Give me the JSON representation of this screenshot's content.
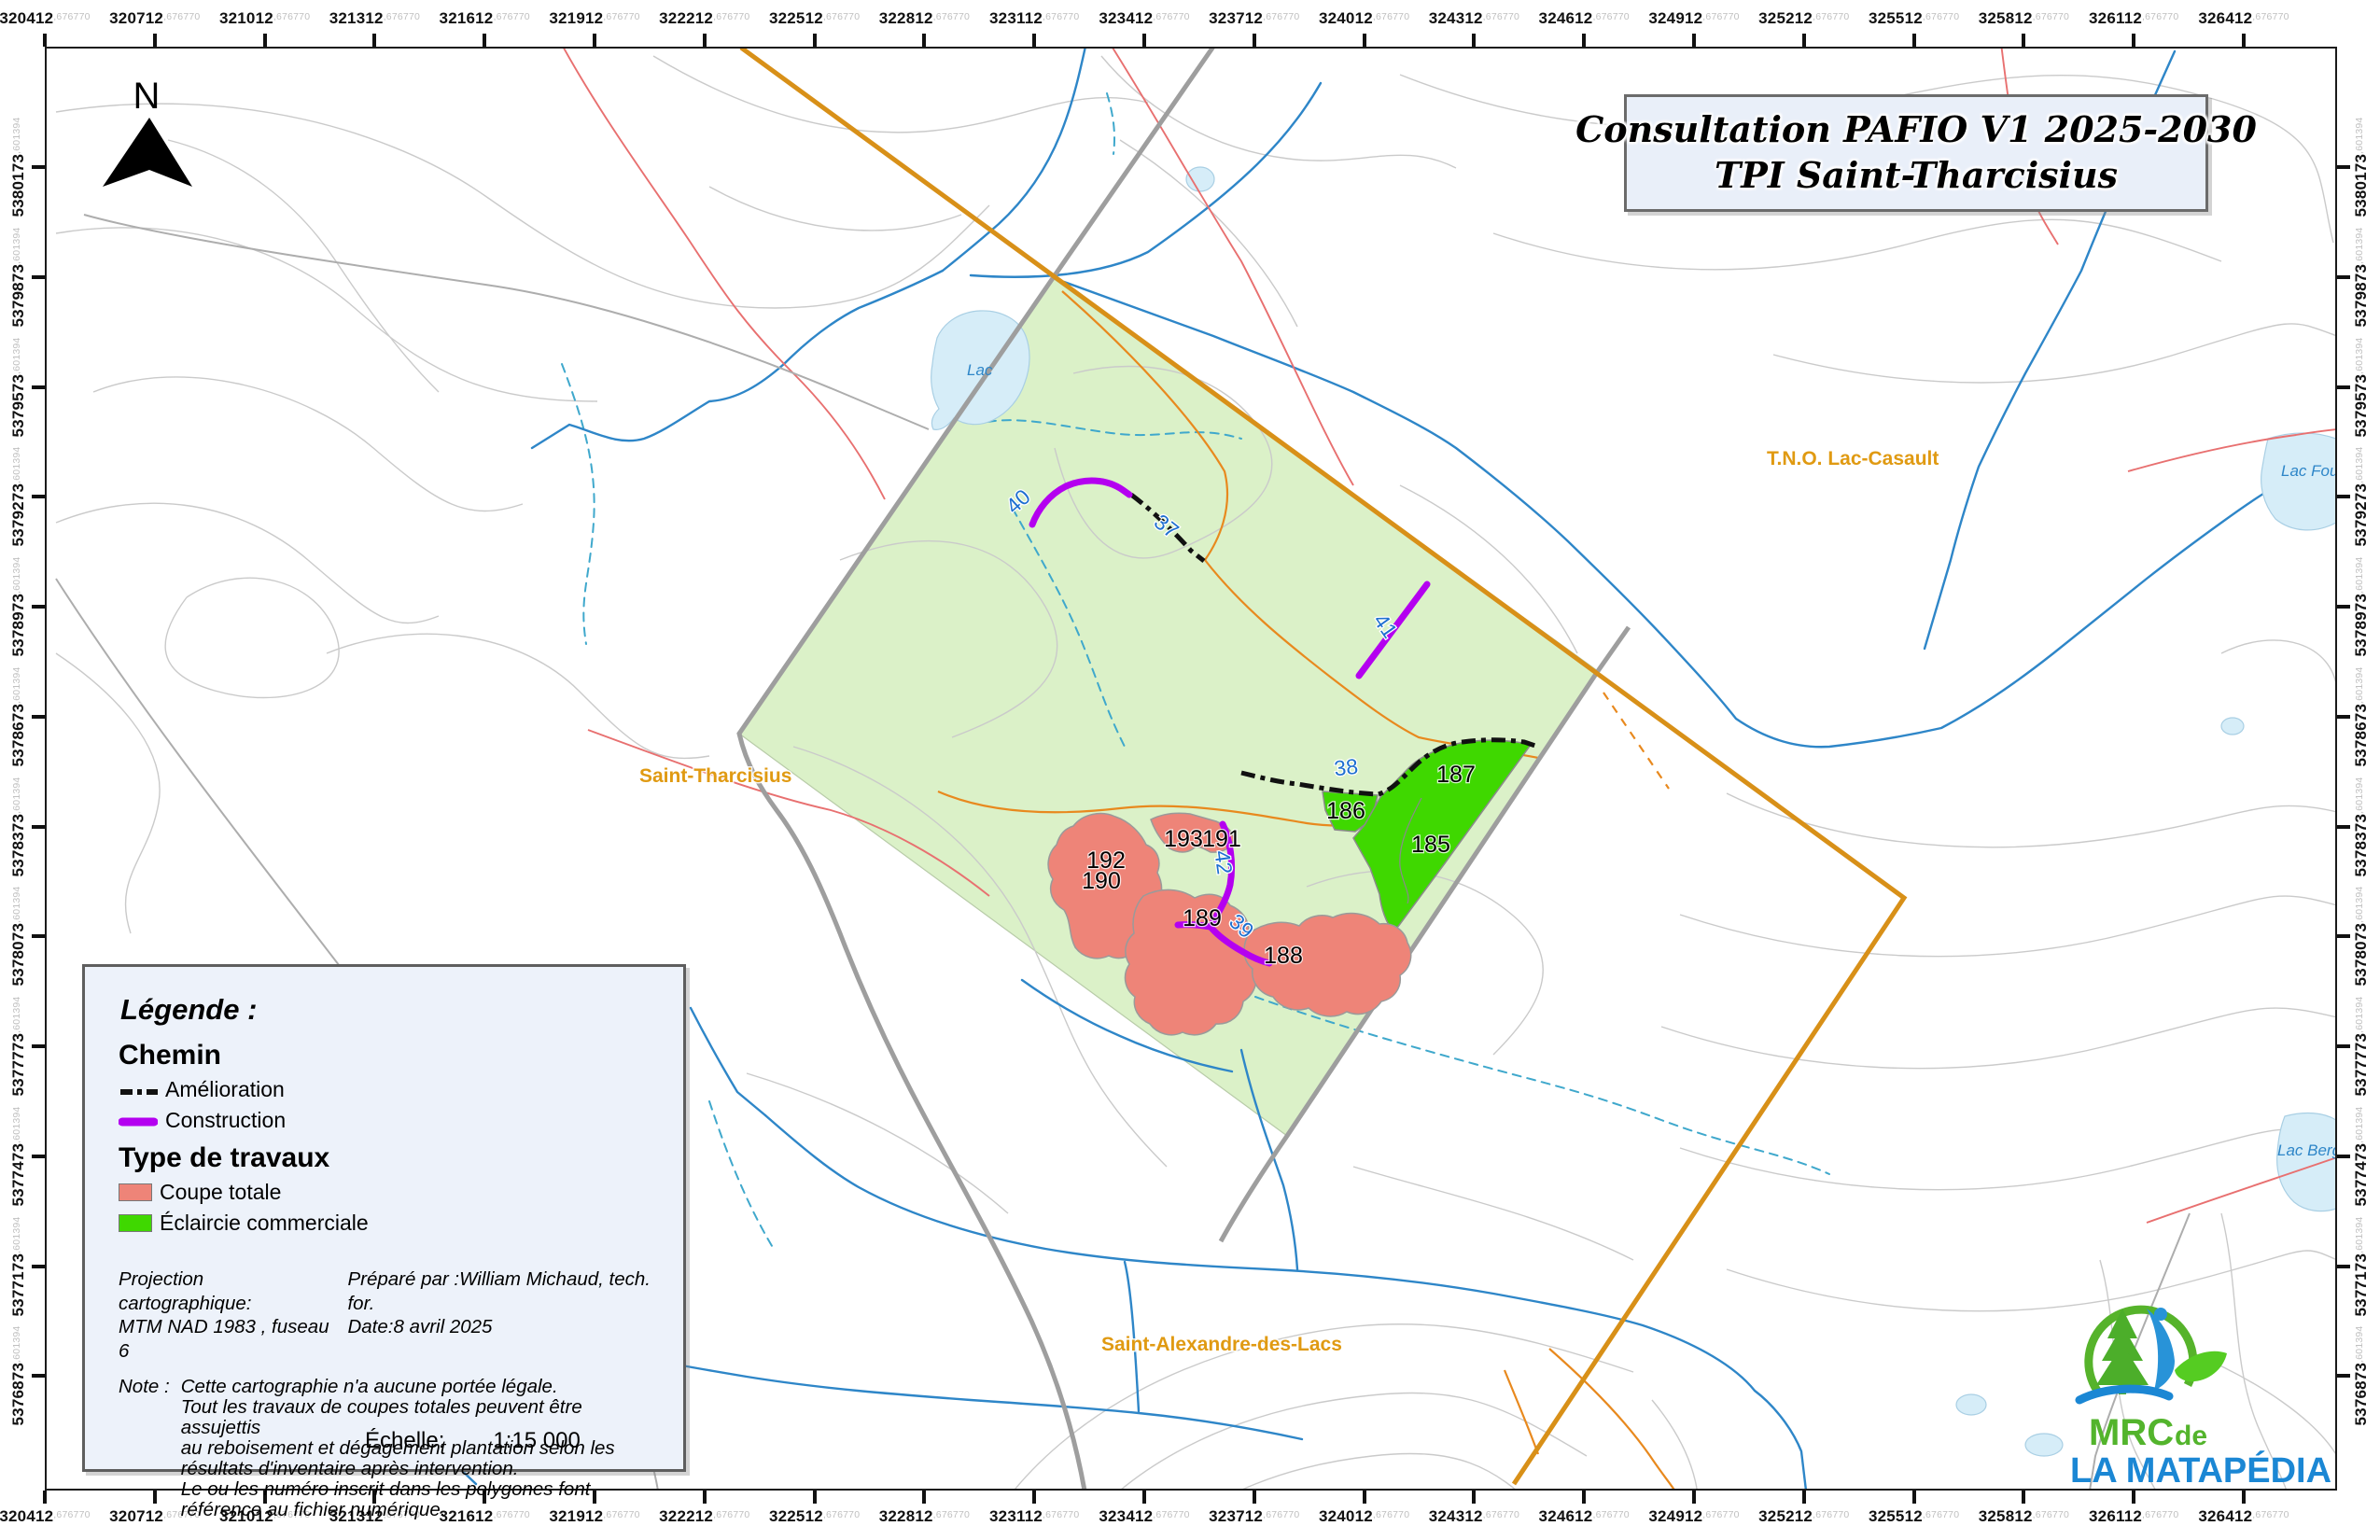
{
  "colors": {
    "frame": "#1a1a1a",
    "tpi_green": "#DBF1C8",
    "cut_pink": "#EE8478",
    "thinning_green": "#3FD800",
    "construction_purple": "#B400F0",
    "improvement_black": "#111111",
    "boundary_orange": "#D89018",
    "road_orange": "#E8891E",
    "road_gray": "#9E9E9E",
    "road_red": "#E87070",
    "contour_gray": "#CACACA",
    "stream_blue": "#2E86C8",
    "stream_dashed_teal": "#3FA8CC",
    "lake_fill": "#D6EDF8",
    "lake_stroke": "#A9CFE4",
    "panel_bg": "#EDF2FA",
    "panel_border": "#5E5E5E",
    "place_orange": "#E09A12",
    "road_label_blue": "#1E6FD0",
    "axis_suffix_gray": "#C0C0C0",
    "logo_green": "#53B42C",
    "logo_blue": "#1B87D4"
  },
  "title": {
    "line1": "Consultation PAFIO V1 2025-2030",
    "line2": "TPI Saint-Tharcisius"
  },
  "north": {
    "label": "N"
  },
  "axes": {
    "x_labels": [
      "320412",
      "320712",
      "321012",
      "321312",
      "321612",
      "321912",
      "322212",
      "322512",
      "322812",
      "323112",
      "323412",
      "323712",
      "324012",
      "324312",
      "324612",
      "324912",
      "325212",
      "325512",
      "325812",
      "326112",
      "326412"
    ],
    "x_suffix": ",676770",
    "y_labels": [
      "5380173",
      "5379873",
      "5379573",
      "5379273",
      "5378973",
      "5378673",
      "5378373",
      "5378073",
      "5377773",
      "5377473",
      "5377173",
      "5376873"
    ],
    "y_suffix": ",601394"
  },
  "legend": {
    "heading": "Légende :",
    "chemin_heading": "Chemin",
    "amelioration": "Amélioration",
    "construction": "Construction",
    "travaux_heading": "Type de travaux",
    "coupe": "Coupe totale",
    "eclaircie": "Éclaircie commerciale",
    "projection_label": "Projection cartographique:",
    "projection_value": "MTM NAD 1983 , fuseau 6",
    "prepared": "Préparé par :William Michaud,  tech. for.",
    "date": "Date:8 avril 2025",
    "note_label": "Note :",
    "note_line1": "Cette cartographie n'a aucune portée légale.",
    "note_line2": "Tout les travaux de coupes totales peuvent être assujettis",
    "note_line3": "au reboisement et dégagement plantation selon les",
    "note_line4": "résultats d'inventaire après intervention.",
    "note_line5": "Le ou les numéro inscrit dans les polygones font",
    "note_line6": "référence au fichier numérique."
  },
  "scale": {
    "label": "Échelle:",
    "value": "1:15 000"
  },
  "logo": {
    "mrc": "MRC",
    "de": "de",
    "name": "LA MATAPÉDIA"
  },
  "map": {
    "places": {
      "saint_tharcisius": "Saint-Tharcisius",
      "tno": "T.N.O. Lac-Casault",
      "saint_alexandre": "Saint-Alexandre-des-Lacs"
    },
    "lakes": {
      "lac": "Lac",
      "fournier": "Lac Fournier",
      "bergeron": "Lac Bergeron"
    },
    "work_labels": {
      "185": "185",
      "186": "186",
      "187": "187",
      "188": "188",
      "189": "189",
      "190": "190",
      "191": "191",
      "192": "192",
      "193": "193"
    },
    "road_labels": {
      "37": "37",
      "38": "38",
      "39": "39",
      "40": "40",
      "41": "41",
      "42": "42"
    }
  }
}
